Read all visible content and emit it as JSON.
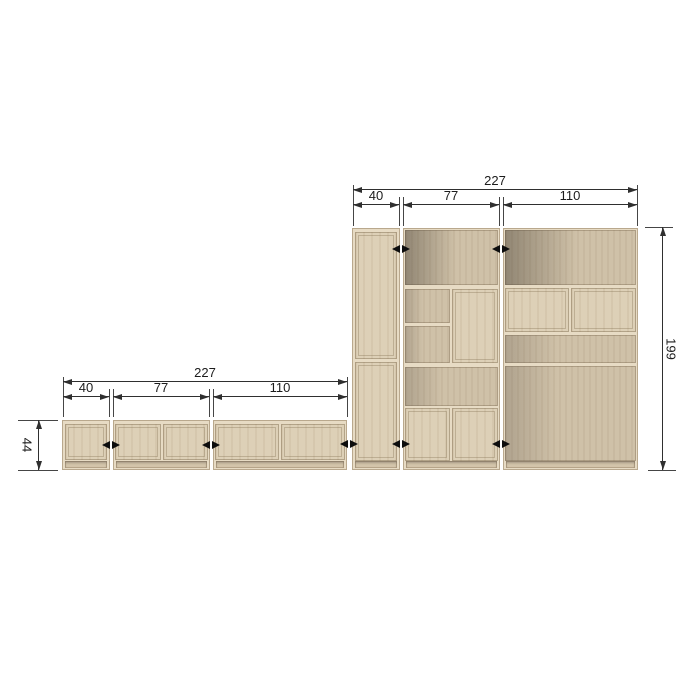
{
  "diagram": {
    "type": "furniture-dimension-drawing",
    "background": "#ffffff"
  },
  "wall_unit": {
    "total_width_label": "227",
    "module_width_labels": [
      "40",
      "77",
      "110"
    ],
    "height_label": "199",
    "modules": [
      {
        "width": "40",
        "description": "tall two-door cabinet"
      },
      {
        "width": "77",
        "description": "open top, shelves with door, open middle, two bottom doors"
      },
      {
        "width": "110",
        "description": "open top, two wall doors, open shelf, large open bottom"
      }
    ]
  },
  "sideboard": {
    "total_width_label": "227",
    "module_width_labels": [
      "40",
      "77",
      "110"
    ],
    "height_label": "44",
    "modules": [
      {
        "width": "40",
        "description": "one-door cabinet"
      },
      {
        "width": "77",
        "description": "two-door cabinet"
      },
      {
        "width": "110",
        "description": "two-door cabinet"
      }
    ]
  },
  "icons": {
    "connector": "double-arrow-icon"
  },
  "colors": {
    "wood": "#dccfb6",
    "wood_open": "#cfc1a8",
    "wood_edge": "#e7dbc4",
    "dimension_line": "#2f2f2f",
    "arrow": "#0d0d0d"
  }
}
